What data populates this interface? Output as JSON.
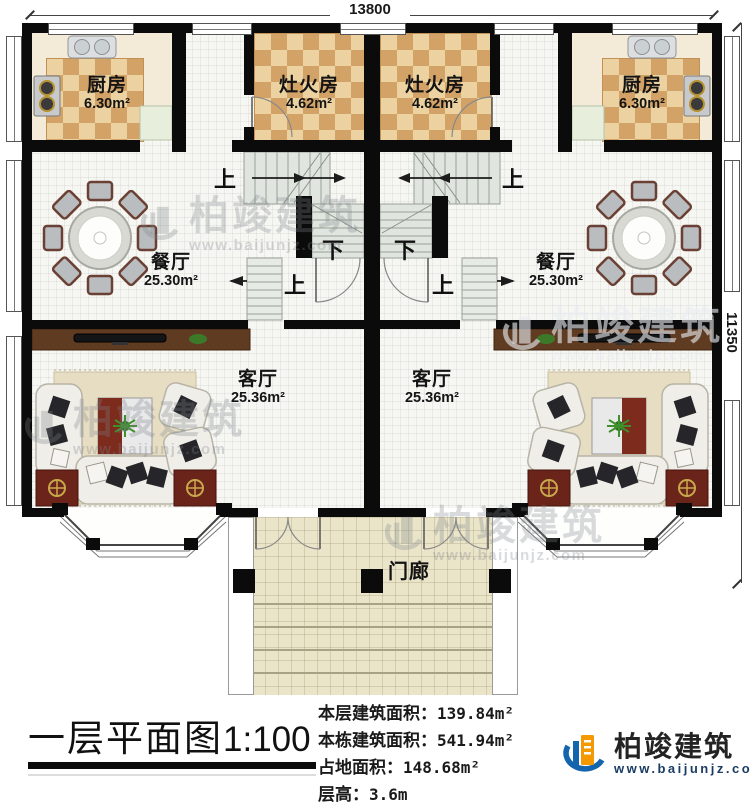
{
  "dims": {
    "top": "13800",
    "right": "11350"
  },
  "rooms": {
    "kitchen_left": {
      "name": "厨房",
      "area": "6.30m²"
    },
    "stove_left": {
      "name": "灶火房",
      "area": "4.62m²"
    },
    "stove_right": {
      "name": "灶火房",
      "area": "4.62m²"
    },
    "kitchen_right": {
      "name": "厨房",
      "area": "6.30m²"
    },
    "dining_left": {
      "name": "餐厅",
      "area": "25.30m²"
    },
    "dining_right": {
      "name": "餐厅",
      "area": "25.30m²"
    },
    "living_left": {
      "name": "客厅",
      "area": "25.36m²"
    },
    "living_right": {
      "name": "客厅",
      "area": "25.36m²"
    },
    "porch": {
      "name": "门廊"
    }
  },
  "stairs": {
    "up": "上",
    "down": "下"
  },
  "titleblock": {
    "title": "一层平面图",
    "scale": "1:100",
    "stats": [
      {
        "label": "本层建筑面积：",
        "value": "139.84m²"
      },
      {
        "label": "本栋建筑面积：",
        "value": "541.94m²"
      },
      {
        "label": "占地面积：",
        "value": "148.68m²"
      },
      {
        "label": "层高：",
        "value": "3.6m"
      }
    ]
  },
  "brand": {
    "name": "柏竣建筑",
    "url": "www.baijunjz.com"
  },
  "colors": {
    "wall": "#0b0b0b",
    "checker_light": "#ecd2a0",
    "checker_dark": "#d3a267",
    "porch_floor": "#eae4c9",
    "stair_tread": "#e0e6df",
    "console_wood": "#5f3b22",
    "rug_red": "#6a241a",
    "brand_blue": "#1565ae",
    "brand_orange": "#f49a00"
  }
}
